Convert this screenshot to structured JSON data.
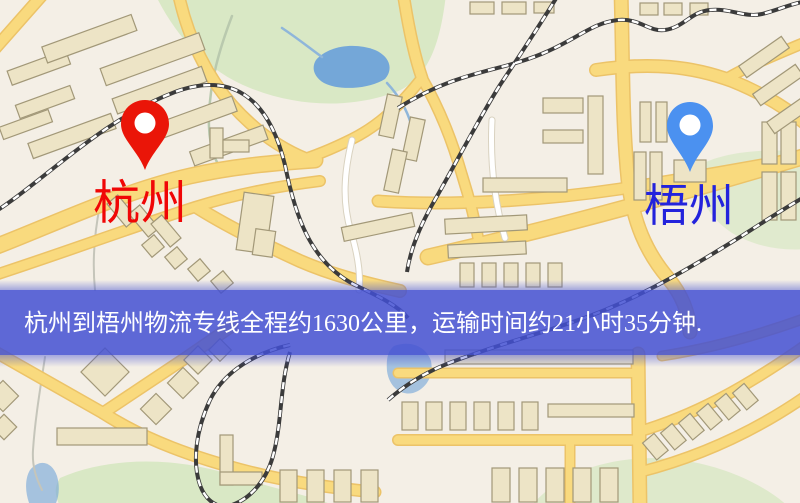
{
  "banner": {
    "text": "杭州到梧州物流专线全程约1630公里，运输时间约21小时35分钟.",
    "bg_color": "#4350d2",
    "text_color": "#ffffff"
  },
  "markers": {
    "origin": {
      "label": "杭州",
      "pin_color": "#ea1508",
      "label_color": "#f00606"
    },
    "destination": {
      "label": "梧州",
      "pin_color": "#4b91f0",
      "label_color": "#2323dc"
    }
  },
  "map_colors": {
    "background": "#f4efe6",
    "road_fill": "#f9da7e",
    "road_casing": "#ecc368",
    "park": "#d9e8c5",
    "water": "#74a7d8",
    "building_fill": "#ede4c6",
    "building_stroke": "#a29878",
    "railway": "#3b3b3b"
  }
}
